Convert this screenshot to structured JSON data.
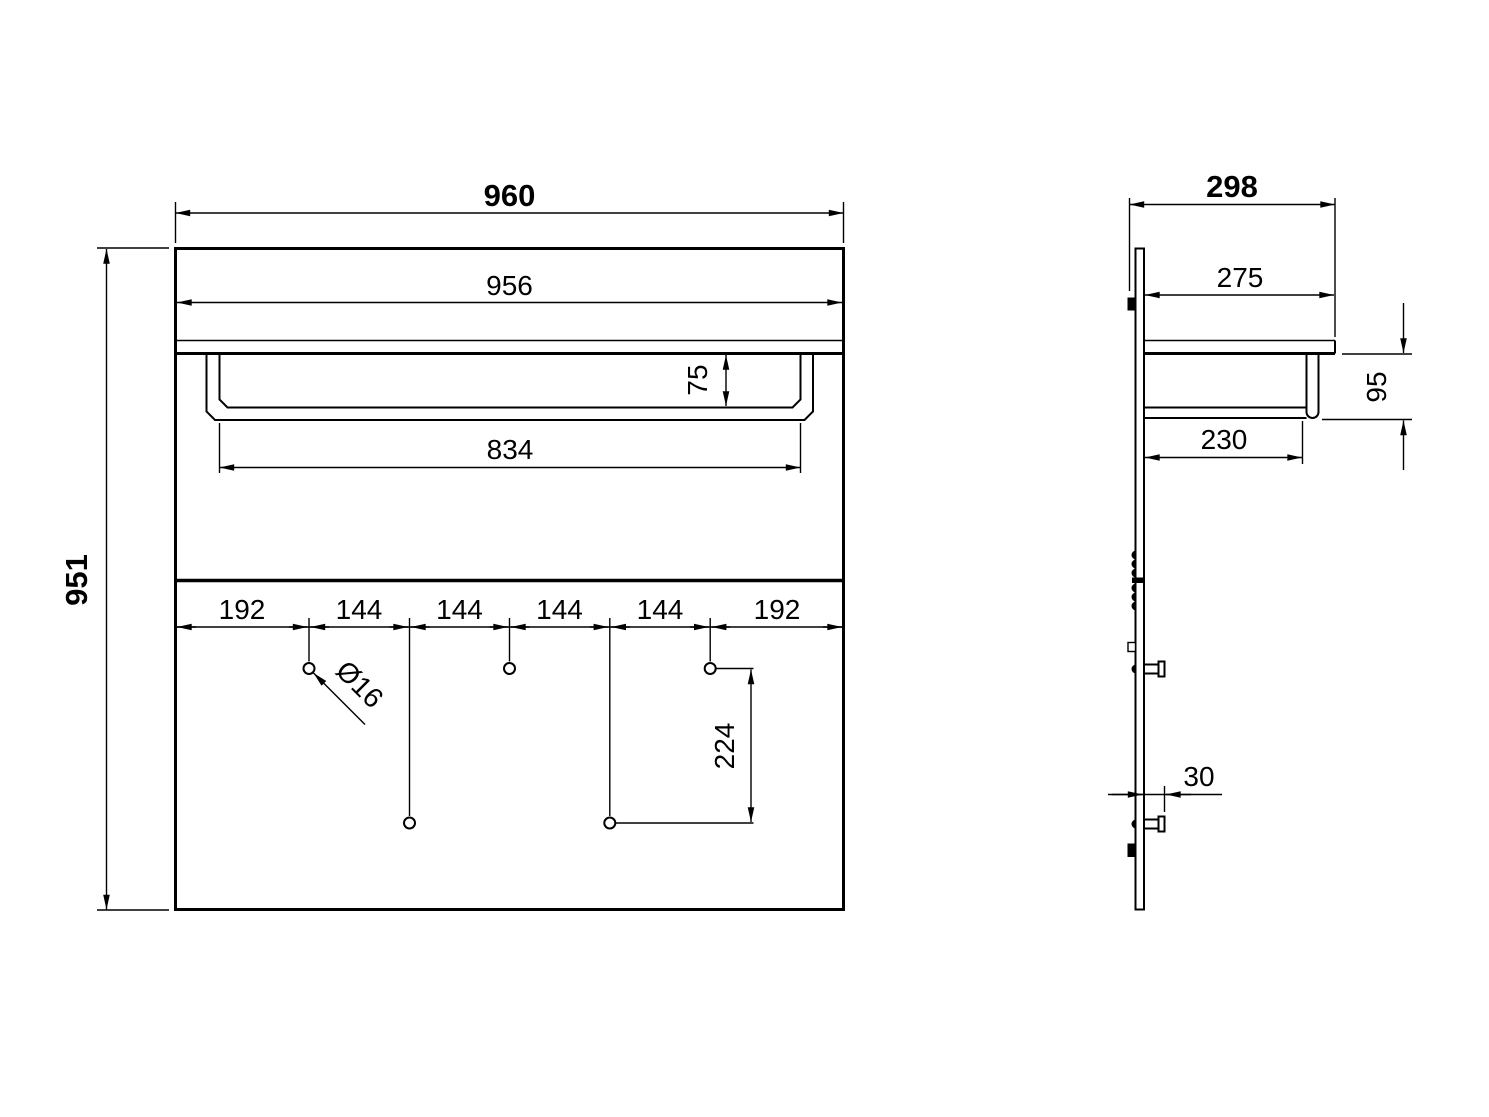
{
  "title": "Wall coat rack with shelf and rail - dimensioned drawing",
  "units": "mm",
  "colors": {
    "line": "#000000",
    "background": "#ffffff"
  },
  "views": {
    "front": {
      "dims": {
        "overall_width": "960",
        "overall_height": "951",
        "shelf_width": "956",
        "bar_drop": "75",
        "bar_inner_width": "834",
        "hook_spacing": [
          "192",
          "144",
          "144",
          "144",
          "144",
          "192"
        ],
        "hole_diameter": "Ø16",
        "hook_row_offset": "224"
      }
    },
    "side": {
      "dims": {
        "overall_depth": "298",
        "shelf_depth": "275",
        "bar_height": "95",
        "bar_reach": "230",
        "peg_length": "30"
      }
    }
  }
}
